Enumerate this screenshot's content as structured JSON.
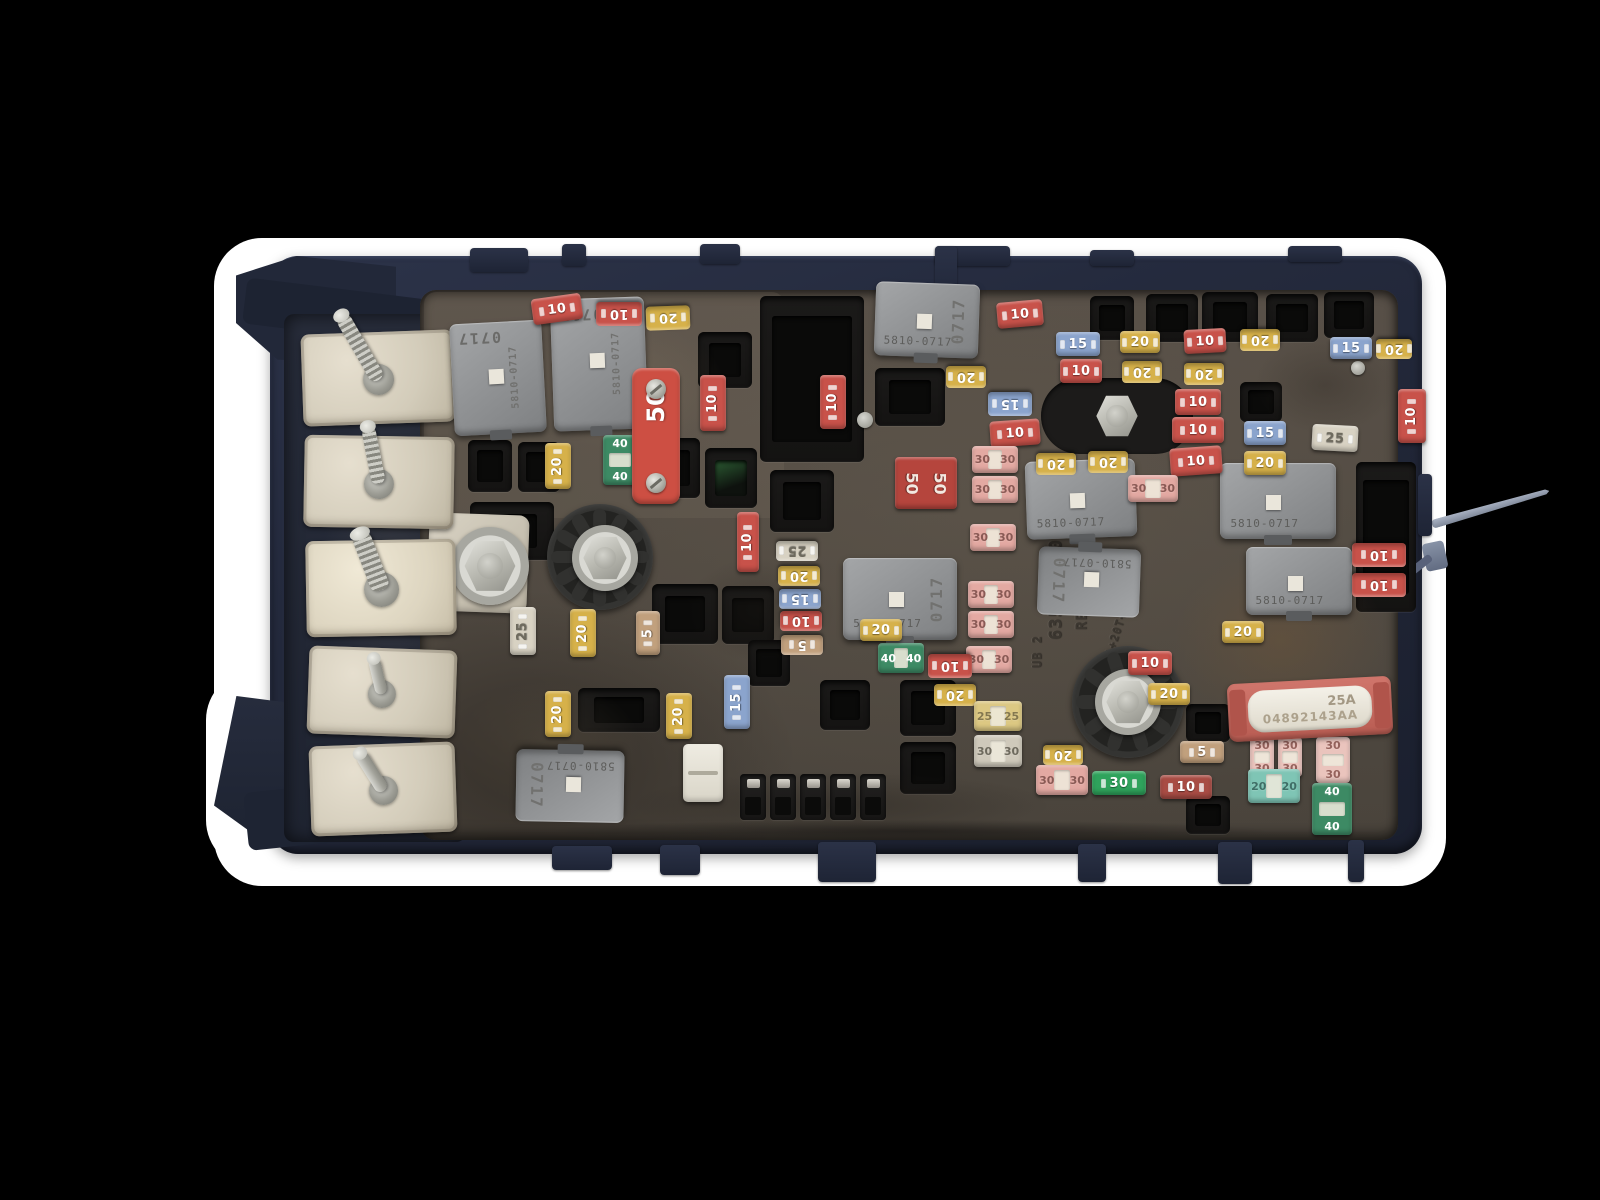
{
  "scene": {
    "width": 1600,
    "height": 1200
  },
  "palette": {
    "canvas": "#000000",
    "backdrop": "#ffffff",
    "housing": "#242a3d",
    "panel": "#514b43",
    "metal": "#c9c6bd"
  },
  "colors": {
    "red": "#c8524a",
    "darkred": "#a84c44",
    "yellow": "#d6b14a",
    "blue": "#8ba4cd",
    "tan": "#c1a07d",
    "white": "#d8d2c3",
    "pink": "#e3a9a2",
    "pinklight": "#eac4bd",
    "brightgreen": "#2fa35c",
    "teal": "#7fc5b5",
    "green": "#3d8a64",
    "ycart": "#dcc883",
    "graycart": "#cfc9bb",
    "maxired": "#cd4f43",
    "jred": "#b5453d"
  },
  "label_dark": {
    "white": "#6e6a5e",
    "ycart": "#84784f",
    "graycart": "#6e6a5e",
    "pink": "#8a5a55",
    "pinklight": "#95625c",
    "teal": "#3f6e66"
  },
  "molded_text": {
    "part_number": "6356-5110",
    "revision": "REV 001",
    "code": "UB 2",
    "material": ">PA+20T+10GF<"
  },
  "fuse_link": {
    "x": 1228,
    "y": 680,
    "w": 164,
    "h": 58,
    "rot": -3,
    "amps": "25A",
    "code": "04892143AA"
  },
  "relays": [
    {
      "x": 452,
      "y": 322,
      "w": 92,
      "h": 112,
      "rot": -3,
      "top": "0717",
      "side": "5810-0717"
    },
    {
      "x": 552,
      "y": 298,
      "w": 94,
      "h": 132,
      "rot": -2,
      "top": "0717",
      "side": "5810-0717"
    },
    {
      "x": 875,
      "y": 283,
      "w": 104,
      "h": 74,
      "rot": 2,
      "label": "5810-0717",
      "side": "0717"
    },
    {
      "x": 843,
      "y": 558,
      "w": 114,
      "h": 82,
      "rot": 0,
      "label": "5810-0717",
      "side": "0717"
    },
    {
      "x": 1026,
      "y": 460,
      "w": 110,
      "h": 78,
      "rot": -2,
      "label": "5810-0717"
    },
    {
      "x": 1038,
      "y": 548,
      "w": 102,
      "h": 68,
      "rot": 182,
      "label": "5810-0717",
      "side": "0717"
    },
    {
      "x": 1220,
      "y": 463,
      "w": 116,
      "h": 76,
      "rot": 0,
      "label": "5810-0717"
    },
    {
      "x": 1246,
      "y": 547,
      "w": 106,
      "h": 68,
      "rot": 0,
      "label": "5810-0717"
    },
    {
      "x": 516,
      "y": 750,
      "w": 108,
      "h": 72,
      "rot": 181,
      "label": "5810-0717",
      "side": "0717"
    }
  ],
  "fuses": [
    [
      532,
      296,
      50,
      26,
      -8,
      "red",
      "10",
      "m"
    ],
    [
      596,
      302,
      46,
      24,
      180,
      "red",
      "10",
      "m"
    ],
    [
      646,
      306,
      44,
      24,
      178,
      "yellow",
      "20",
      "m"
    ],
    [
      997,
      301,
      46,
      26,
      -5,
      "red",
      "10",
      "m"
    ],
    [
      1056,
      332,
      44,
      24,
      0,
      "blue",
      "15",
      "m"
    ],
    [
      1120,
      331,
      40,
      22,
      0,
      "yellow",
      "20",
      "m"
    ],
    [
      1184,
      329,
      42,
      24,
      -3,
      "red",
      "10",
      "m"
    ],
    [
      1240,
      329,
      40,
      22,
      180,
      "yellow",
      "20",
      "m"
    ],
    [
      1060,
      359,
      42,
      24,
      0,
      "red",
      "10",
      "m"
    ],
    [
      1122,
      361,
      40,
      22,
      180,
      "yellow",
      "20",
      "m"
    ],
    [
      1184,
      363,
      40,
      22,
      180,
      "yellow",
      "20",
      "m"
    ],
    [
      1330,
      337,
      42,
      22,
      0,
      "blue",
      "15",
      "m"
    ],
    [
      1376,
      339,
      36,
      20,
      180,
      "yellow",
      "20",
      "m"
    ],
    [
      946,
      366,
      40,
      22,
      180,
      "yellow",
      "20",
      "m"
    ],
    [
      988,
      392,
      44,
      24,
      180,
      "blue",
      "15",
      "m"
    ],
    [
      990,
      420,
      50,
      26,
      -4,
      "red",
      "10",
      "m"
    ],
    [
      1175,
      389,
      46,
      26,
      0,
      "red",
      "10",
      "m"
    ],
    [
      1172,
      417,
      52,
      26,
      0,
      "red",
      "10",
      "m"
    ],
    [
      1244,
      421,
      42,
      24,
      0,
      "blue",
      "15",
      "m"
    ],
    [
      1312,
      425,
      46,
      26,
      3,
      "white",
      "25",
      "m"
    ],
    [
      1170,
      447,
      52,
      28,
      -4,
      "red",
      "10",
      "m"
    ],
    [
      1244,
      451,
      42,
      24,
      0,
      "yellow",
      "20",
      "m"
    ],
    [
      700,
      375,
      26,
      56,
      0,
      "red",
      "10",
      "mv"
    ],
    [
      820,
      375,
      26,
      54,
      0,
      "red",
      "10",
      "mv"
    ],
    [
      737,
      512,
      22,
      60,
      0,
      "red",
      "10",
      "mv"
    ],
    [
      545,
      443,
      26,
      46,
      0,
      "yellow",
      "20",
      "mv"
    ],
    [
      603,
      435,
      34,
      50,
      0,
      "green",
      "40",
      "cv"
    ],
    [
      632,
      368,
      48,
      136,
      0,
      "maxired",
      "50",
      "maxi"
    ],
    [
      895,
      457,
      62,
      52,
      0,
      "jred",
      "50",
      "j"
    ],
    [
      972,
      446,
      46,
      27,
      0,
      "pink",
      "30",
      "c"
    ],
    [
      972,
      476,
      46,
      27,
      0,
      "pink",
      "30",
      "c"
    ],
    [
      970,
      524,
      46,
      27,
      0,
      "pink",
      "30",
      "c"
    ],
    [
      968,
      581,
      46,
      27,
      0,
      "pink",
      "30",
      "c"
    ],
    [
      968,
      611,
      46,
      27,
      0,
      "pink",
      "30",
      "c"
    ],
    [
      966,
      646,
      46,
      27,
      0,
      "pink",
      "30",
      "c"
    ],
    [
      1128,
      475,
      50,
      27,
      0,
      "pink",
      "30",
      "c"
    ],
    [
      1036,
      453,
      40,
      22,
      180,
      "yellow",
      "20",
      "m"
    ],
    [
      1088,
      451,
      40,
      22,
      180,
      "yellow",
      "20",
      "m"
    ],
    [
      510,
      607,
      26,
      48,
      0,
      "white",
      "25",
      "mv"
    ],
    [
      570,
      609,
      26,
      48,
      0,
      "yellow",
      "20",
      "mv"
    ],
    [
      636,
      611,
      24,
      44,
      0,
      "tan",
      "5",
      "mv"
    ],
    [
      776,
      541,
      42,
      20,
      180,
      "white",
      "25",
      "m"
    ],
    [
      778,
      566,
      42,
      20,
      180,
      "yellow",
      "20",
      "m"
    ],
    [
      779,
      589,
      42,
      20,
      180,
      "blue",
      "15",
      "m"
    ],
    [
      780,
      611,
      42,
      20,
      180,
      "red",
      "10",
      "m"
    ],
    [
      781,
      635,
      42,
      20,
      180,
      "tan",
      "5",
      "m"
    ],
    [
      545,
      691,
      26,
      46,
      0,
      "yellow",
      "20",
      "mv"
    ],
    [
      666,
      693,
      26,
      46,
      0,
      "yellow",
      "20",
      "mv"
    ],
    [
      724,
      675,
      26,
      54,
      0,
      "blue",
      "15",
      "mv"
    ],
    [
      878,
      643,
      46,
      30,
      0,
      "green",
      "40",
      "c"
    ],
    [
      928,
      654,
      44,
      24,
      180,
      "red",
      "10",
      "m"
    ],
    [
      860,
      619,
      42,
      22,
      0,
      "yellow",
      "20",
      "m"
    ],
    [
      934,
      684,
      42,
      22,
      180,
      "yellow",
      "20",
      "m"
    ],
    [
      974,
      701,
      48,
      30,
      0,
      "ycart",
      "25",
      "c"
    ],
    [
      974,
      735,
      48,
      32,
      0,
      "graycart",
      "30",
      "c"
    ],
    [
      1036,
      765,
      52,
      30,
      0,
      "pink",
      "30",
      "c"
    ],
    [
      1043,
      745,
      40,
      20,
      180,
      "yellow",
      "20",
      "m"
    ],
    [
      1128,
      651,
      44,
      24,
      0,
      "red",
      "10",
      "m"
    ],
    [
      1148,
      683,
      42,
      22,
      0,
      "yellow",
      "20",
      "m"
    ],
    [
      1092,
      771,
      54,
      24,
      0,
      "brightgreen",
      "30",
      "m"
    ],
    [
      1160,
      775,
      52,
      24,
      0,
      "darkred",
      "10",
      "m"
    ],
    [
      1180,
      741,
      44,
      22,
      0,
      "tan",
      "5",
      "m"
    ],
    [
      1222,
      621,
      42,
      22,
      0,
      "yellow",
      "20",
      "m"
    ],
    [
      1250,
      737,
      24,
      40,
      0,
      "pinklight",
      "30",
      "cv"
    ],
    [
      1278,
      737,
      24,
      40,
      0,
      "pinklight",
      "30",
      "cv"
    ],
    [
      1248,
      769,
      52,
      34,
      0,
      "teal",
      "20",
      "c"
    ],
    [
      1316,
      737,
      34,
      46,
      0,
      "pinklight",
      "30",
      "cv"
    ],
    [
      1312,
      783,
      40,
      52,
      0,
      "green",
      "40",
      "cv"
    ],
    [
      1352,
      543,
      54,
      24,
      180,
      "red",
      "10",
      "m"
    ],
    [
      1352,
      573,
      54,
      24,
      180,
      "red",
      "10",
      "m"
    ],
    [
      1398,
      389,
      28,
      54,
      0,
      "red",
      "10",
      "mv"
    ]
  ],
  "sockets": [
    [
      468,
      440,
      44,
      52
    ],
    [
      518,
      442,
      42,
      50
    ],
    [
      470,
      502,
      84,
      58
    ],
    [
      652,
      438,
      48,
      60
    ],
    [
      705,
      448,
      52,
      60,
      "green"
    ],
    [
      760,
      296,
      104,
      166,
      "big"
    ],
    [
      875,
      368,
      70,
      58
    ],
    [
      770,
      470,
      64,
      62
    ],
    [
      698,
      332,
      54,
      56
    ],
    [
      652,
      584,
      66,
      60
    ],
    [
      722,
      586,
      52,
      58
    ],
    [
      748,
      640,
      42,
      46
    ],
    [
      578,
      688,
      82,
      44
    ],
    [
      900,
      680,
      56,
      56
    ],
    [
      900,
      742,
      56,
      52
    ],
    [
      820,
      680,
      50,
      50
    ],
    [
      1090,
      296,
      44,
      44
    ],
    [
      1146,
      294,
      52,
      48
    ],
    [
      1202,
      292,
      56,
      50
    ],
    [
      1266,
      294,
      52,
      48
    ],
    [
      1324,
      292,
      50,
      46
    ],
    [
      1240,
      382,
      42,
      40
    ],
    [
      1356,
      462,
      60,
      150,
      "big"
    ],
    [
      1186,
      704,
      44,
      38
    ],
    [
      1186,
      796,
      44,
      38
    ]
  ],
  "connector_row": {
    "x": 740,
    "y": 774,
    "count": 5,
    "w": 26,
    "h": 46,
    "gap": 4
  },
  "white_connector": {
    "x": 683,
    "y": 744,
    "w": 40,
    "h": 58
  },
  "studs": [
    {
      "x": 302,
      "y": 332,
      "w": 152,
      "h": 92,
      "tilt": -2,
      "len": 74,
      "sw": 15,
      "deg": -28,
      "thread": true
    },
    {
      "x": 304,
      "y": 436,
      "w": 150,
      "h": 92,
      "tilt": 1,
      "len": 58,
      "sw": 14,
      "deg": -12,
      "thread": true
    },
    {
      "x": 306,
      "y": 540,
      "w": 150,
      "h": 96,
      "tilt": -1,
      "len": 60,
      "sw": 19,
      "deg": -20,
      "thread": true,
      "bright": true
    },
    {
      "x": 308,
      "y": 648,
      "w": 148,
      "h": 88,
      "tilt": 2,
      "len": 36,
      "sw": 12,
      "deg": -15,
      "thread": false
    },
    {
      "x": 310,
      "y": 744,
      "w": 146,
      "h": 90,
      "tilt": -2,
      "len": 44,
      "sw": 13,
      "deg": -30,
      "thread": false
    }
  ],
  "wheels": [
    [
      600,
      557,
      53,
      6
    ],
    [
      1128,
      702,
      56,
      5
    ]
  ],
  "hex_bolts": [
    {
      "cx": 605,
      "cy": 558,
      "s": 46,
      "washer": true
    },
    {
      "cx": 1128,
      "cy": 702,
      "s": 46,
      "washer": true
    },
    {
      "cx": 1117,
      "cy": 416,
      "s": 44,
      "base": true
    },
    {
      "cx": 490,
      "cy": 566,
      "s": 54,
      "washer": true
    }
  ],
  "pins": [
    [
      865,
      420,
      16
    ],
    [
      1358,
      368,
      14
    ]
  ],
  "busbar": [
    [
      428,
      514,
      100,
      98,
      2
    ],
    [
      382,
      546,
      62,
      60,
      -4
    ]
  ],
  "tabs": [
    [
      470,
      248,
      58,
      24
    ],
    [
      562,
      244,
      24,
      22
    ],
    [
      700,
      244,
      40,
      20
    ],
    [
      935,
      246,
      75,
      20
    ],
    [
      935,
      246,
      22,
      70
    ],
    [
      1090,
      250,
      44,
      16
    ],
    [
      1288,
      246,
      54,
      16
    ],
    [
      552,
      846,
      60,
      24
    ],
    [
      660,
      845,
      40,
      30
    ],
    [
      818,
      842,
      58,
      40
    ],
    [
      1078,
      844,
      28,
      38
    ],
    [
      1218,
      842,
      34,
      42
    ],
    [
      1348,
      840,
      16,
      42
    ],
    [
      1418,
      474,
      14,
      62
    ]
  ],
  "grime": [
    [
      1140,
      520,
      280,
      240,
      "#7a5a36",
      0.32
    ],
    [
      480,
      300,
      280,
      170,
      "#9b8a6a",
      0.22
    ],
    [
      560,
      760,
      560,
      90,
      "#1f1b16",
      0.38
    ],
    [
      430,
      660,
      240,
      170,
      "#6e6450",
      0.25
    ],
    [
      1230,
      320,
      190,
      130,
      "#2f2922",
      0.35
    ],
    [
      660,
      540,
      200,
      140,
      "#24201b",
      0.3
    ],
    [
      300,
      330,
      180,
      480,
      "#8a8270",
      0.15
    ],
    [
      430,
      816,
      960,
      30,
      "#141210",
      0.55
    ]
  ]
}
